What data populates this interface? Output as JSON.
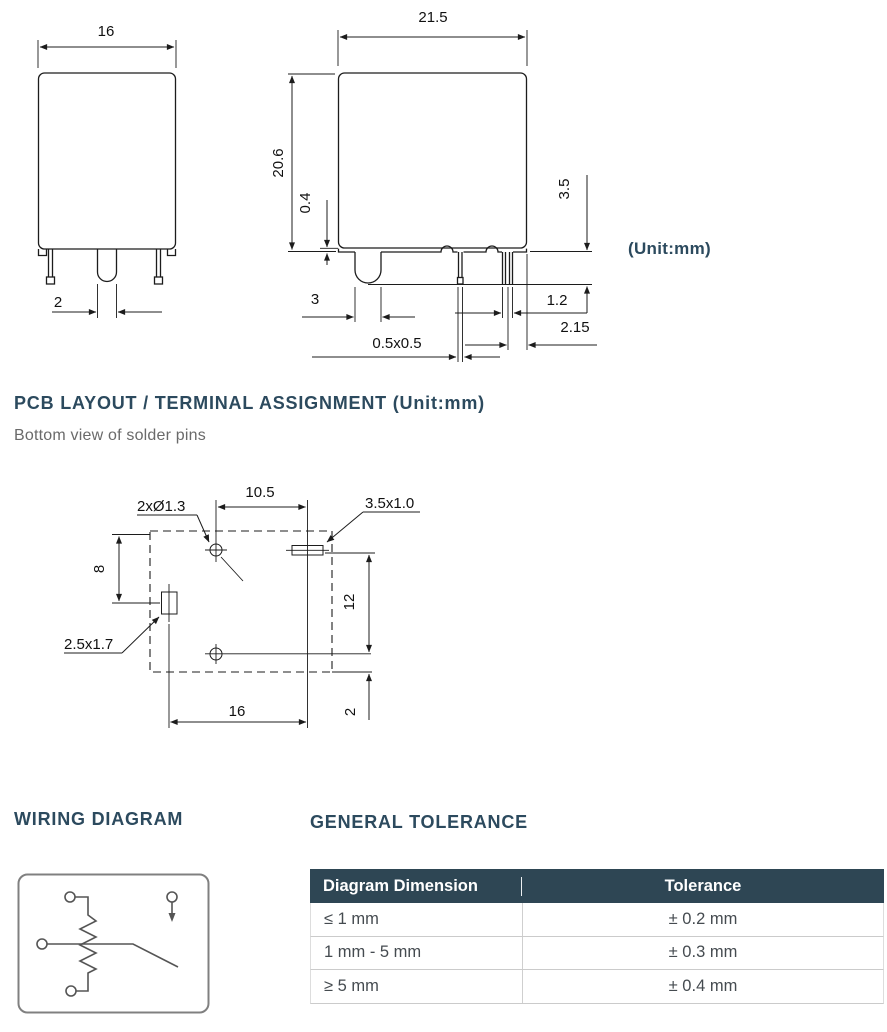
{
  "page": {
    "unit_note": "(Unit:mm)"
  },
  "front_view": {
    "dim_width": "16",
    "dim_pin_width": "2"
  },
  "side_view": {
    "dim_width": "21.5",
    "dim_height": "20.6",
    "dim_standoff": "0.4",
    "dim_pin_length": "3.5",
    "dim_coil_pin_width": "3",
    "dim_pin_section": "0.5x0.5",
    "dim_pin_pair_gap": "1.2",
    "dim_pin_edge": "2.15"
  },
  "pcb_section": {
    "heading": "PCB LAYOUT / TERMINAL ASSIGNMENT (Unit:mm)",
    "subtitle": "Bottom view of solder pins",
    "label_holes": "2xØ1.3",
    "label_slot": "3.5x1.0",
    "label_pad": "2.5x1.7",
    "dim_top": "10.5",
    "dim_left": "8",
    "dim_right": "12",
    "dim_bottom": "16",
    "dim_offset": "2"
  },
  "wiring_section": {
    "heading": "WIRING DIAGRAM"
  },
  "tolerance_section": {
    "heading": "GENERAL TOLERANCE",
    "col_dimension": "Diagram Dimension",
    "col_tolerance": "Tolerance",
    "rows": [
      {
        "dimension": "≤ 1 mm",
        "tolerance": "± 0.2 mm"
      },
      {
        "dimension": "1 mm - 5 mm",
        "tolerance": "± 0.3 mm"
      },
      {
        "dimension": "≥ 5 mm",
        "tolerance": "± 0.4 mm"
      }
    ]
  },
  "colors": {
    "heading": "#2c4a5e",
    "table_header_bg": "#2e4654",
    "line": "#1c1c1c"
  }
}
